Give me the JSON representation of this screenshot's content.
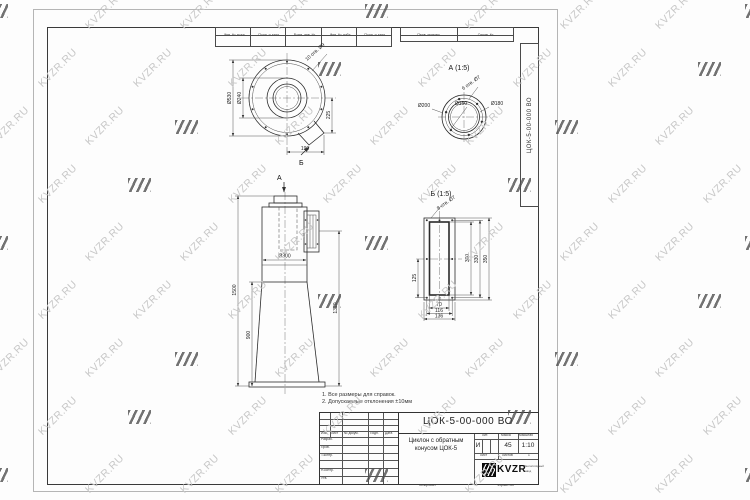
{
  "watermark": {
    "text": "KVZR.RU"
  },
  "frame_labels": {
    "inv_podl": "Инв. № подл.",
    "podp_data1": "Подп. и дата",
    "vzam_inv": "Взам. инв. №",
    "inv_dubl": "Инв. № дубл.",
    "podp_data2": "Подп. и дата",
    "perv_primen": "Перв. примен.",
    "sprav_no": "Справ. №",
    "side_designation": "ЦОК-5-00-000 ВО"
  },
  "views": {
    "top": {
      "dia_outer": "Ø530",
      "dia_inner": "Ø240",
      "dim_right": "225",
      "dim_bottom": "190",
      "holes_note": "10 отв. Ø9",
      "section_b": "Б",
      "section_a": "А"
    },
    "a": {
      "title": "А (1:5)",
      "dia_left": "Ø200",
      "dia_mid": "Ø150",
      "dia_right": "Ø180",
      "holes_note": "6 отв. Ø7"
    },
    "b": {
      "title": "Б (1:5)",
      "holes_note": "8 отв. Ø7",
      "dim_300": "300",
      "dim_330": "330",
      "dim_350": "350",
      "dim_70": "70",
      "dim_116": "116",
      "dim_136": "136",
      "dim_125": "125"
    },
    "front": {
      "dia": "Ø300",
      "total_height": "1500",
      "cone_height": "900",
      "right_height": "1320"
    }
  },
  "notes": {
    "line1": "1.  Все размеры для справок.",
    "line2": "2.  Допускаемые отклонения ±10мм"
  },
  "title_block": {
    "designation": "ЦОК-5-00-000 ВО",
    "name_line1": "Циклон с обратным",
    "name_line2": "конусом ЦОК-5",
    "col_izm": "Изм.",
    "col_list": "Лист",
    "col_doc": "№ докум.",
    "col_podp": "Подп.",
    "col_data": "Дата",
    "row_razrab": "Разраб.",
    "row_prov": "Пров.",
    "row_tkontr": "Т.контр.",
    "row_nkontr": "Н.контр.",
    "row_utv": "Утв.",
    "lit_label": "Лит.",
    "mass_label": "Масса",
    "scale_label": "Масштаб",
    "lit_value": "И",
    "mass_value": "45",
    "scale_value": "1:10",
    "sheet_label": "Лист",
    "sheets_label": "Листов",
    "sheets_value": "1",
    "logo_text": "KVZR",
    "company_line1": "Вентиляторный",
    "company_line2": "завод",
    "copied_label": "Копировал",
    "format_label": "Формат А3"
  }
}
